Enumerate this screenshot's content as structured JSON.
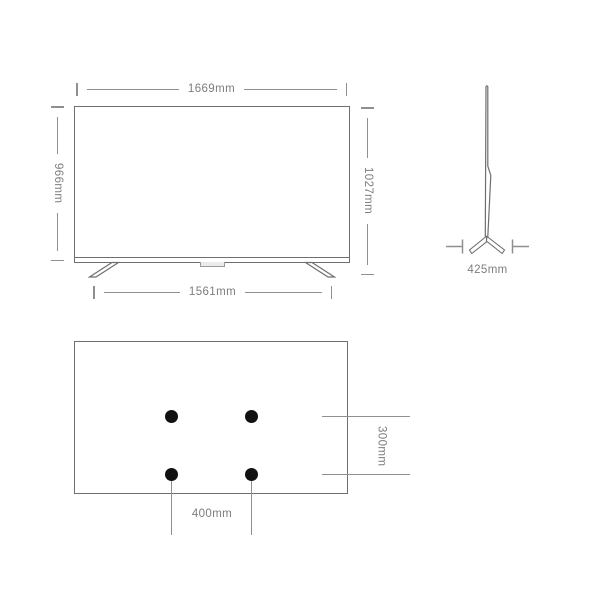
{
  "diagram": {
    "title": "tv-dimensions-spec-diagram",
    "front_view": {
      "overall_width": "1669mm",
      "panel_height": "966mm",
      "total_height_with_stand": "1027mm",
      "stand_feet_span": "1561mm"
    },
    "side_view": {
      "base_depth": "425mm"
    },
    "rear_view": {
      "vesa_pattern_width": "400mm",
      "vesa_pattern_height": "300mm",
      "mount_hole_count": 4
    },
    "colors": {
      "background": "#ffffff",
      "drawing_line": "#6f6f6f",
      "dimension_line": "#8f8f8f",
      "label_text": "#7d7d7d",
      "mount_hole": "#111111"
    }
  }
}
